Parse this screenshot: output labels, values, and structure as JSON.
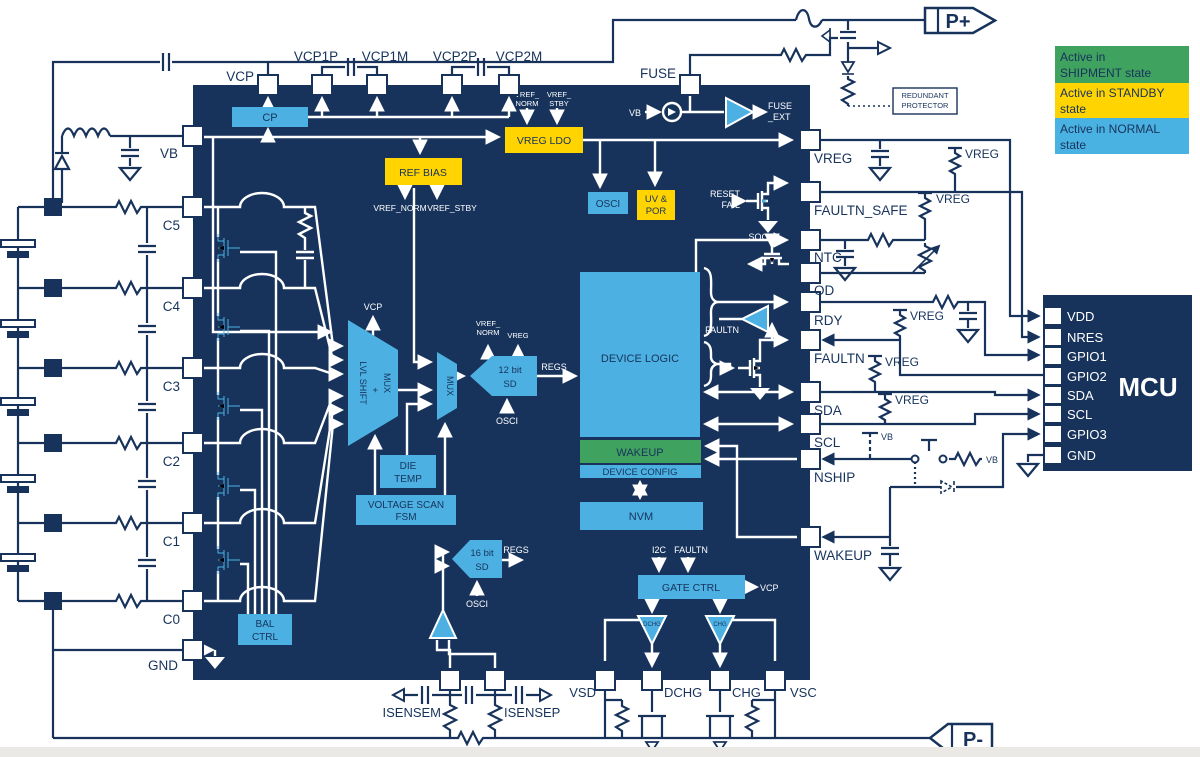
{
  "colors": {
    "navy": "#17335c",
    "block_blue": "#4cb1e2",
    "yellow": "#ffd400",
    "green": "#40a25f",
    "legend_blue": "#4ab2e2",
    "background": "#ffffff"
  },
  "legend": {
    "items": [
      {
        "lines": [
          "Active in",
          "SHIPMENT state"
        ],
        "color": "#40a25f"
      },
      {
        "lines": [
          "Active in STANDBY",
          "state"
        ],
        "color": "#ffd400"
      },
      {
        "lines": [
          "Active in NORMAL",
          "state"
        ],
        "color": "#4ab2e2"
      }
    ]
  },
  "terminals": {
    "positive": "P+",
    "negative": "P-"
  },
  "external": {
    "redundant_protector": [
      "REDUNDANT",
      "PROTECTOR"
    ],
    "vb": "VB",
    "vreg": "VREG"
  },
  "chip": {
    "top_pins": [
      "VCP",
      "VCP1P",
      "VCP1M",
      "VCP2P",
      "VCP2M",
      "FUSE"
    ],
    "left_pins": [
      "VB",
      "C5",
      "C4",
      "C3",
      "C2",
      "C1",
      "C0",
      "GND"
    ],
    "right_pins": [
      "VREG",
      "FAULTN_SAFE",
      "NTC",
      "OD",
      "RDY",
      "FAULTN",
      "SDA",
      "SCL",
      "NSHIP",
      "WAKEUP"
    ],
    "bottom_pins": [
      "ISENSEM",
      "ISENSEP",
      "VSD",
      "DCHG",
      "CHG",
      "VSC"
    ],
    "blocks": {
      "cp": "CP",
      "vreg_ldo": "VREG LDO",
      "ref_bias": "REF BIAS",
      "osci": "OSCI",
      "uv_por": [
        "UV &",
        "POR"
      ],
      "lvl_shift_mux": [
        "LVL SHIFT",
        "+",
        "MUX"
      ],
      "mux": "MUX",
      "sd12": [
        "12 bit",
        "SD"
      ],
      "sd16": [
        "16 bit",
        "SD"
      ],
      "die_temp": [
        "DIE",
        "TEMP"
      ],
      "voltage_scan_fsm": [
        "VOLTAGE SCAN",
        "FSM"
      ],
      "bal_ctrl": [
        "BAL",
        "CTRL"
      ],
      "device_logic": "DEVICE LOGIC",
      "wakeup": "WAKEUP",
      "device_config": "DEVICE CONFIG",
      "nvm": "NVM",
      "gate_ctrl": "GATE CTRL"
    },
    "signals": {
      "vref_norm": "VREF_NORM",
      "vref_stby": "VREF_STBY",
      "vref2": [
        "VREF_",
        "NORM"
      ],
      "vstby2": [
        "VREF_",
        "STBY"
      ],
      "vreg": "VREG",
      "vb": "VB",
      "vcp": "VCP",
      "osci": "OSCI",
      "regs": "REGS",
      "fuse_ext": [
        "FUSE",
        "_EXT"
      ],
      "reset_fail": [
        "RESET",
        "FAIL"
      ],
      "soc": "SOC",
      "faultn": "FAULTN",
      "i2c": "I2C",
      "dchg": "DCHG",
      "chg": "CHG"
    }
  },
  "mcu": {
    "title": "MCU",
    "pins": [
      "VDD",
      "NRES",
      "GPIO1",
      "GPIO2",
      "SDA",
      "SCL",
      "GPIO3",
      "GND"
    ]
  }
}
